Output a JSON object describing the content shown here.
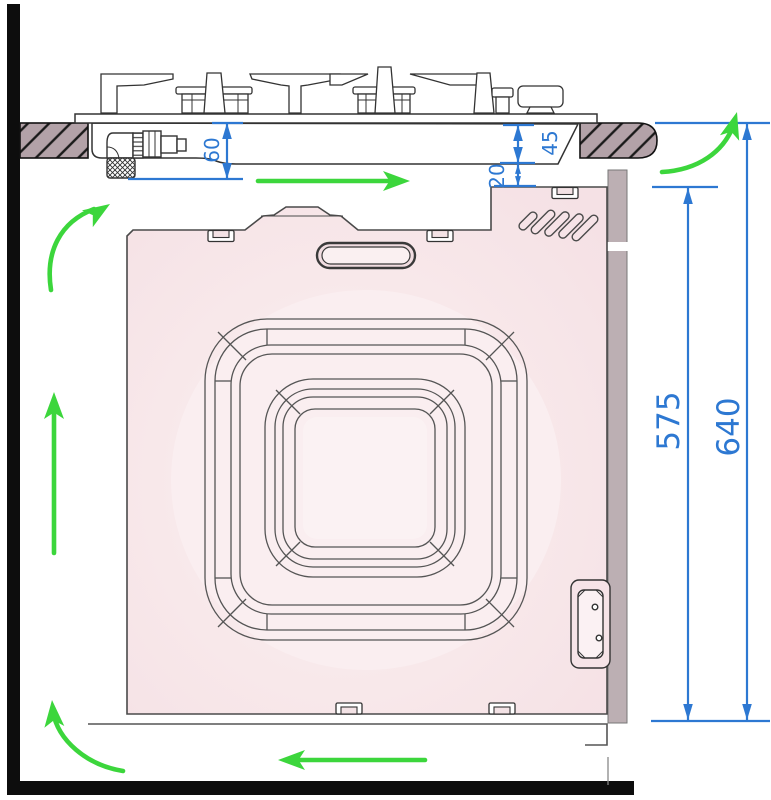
{
  "diagram": {
    "type": "built-in-oven-installation-cross-section",
    "dimensions": {
      "hob_depth": "60",
      "hob_clearance": "45",
      "oven_top_gap": "20",
      "oven_recess_height": "575",
      "niche_total_height": "640"
    },
    "colors": {
      "dimension_blue": "#2d78d2",
      "airflow_green": "#3cd63c",
      "oven_body_pink": "#f7e5e8",
      "rear_panel_grey": "#bcafb3",
      "worktop_grey": "#b3a2a8",
      "wall_black": "#0d0d0d"
    },
    "airflow_arrows": [
      {
        "name": "airflow-under-hob-arrow",
        "direction": "right"
      },
      {
        "name": "airflow-top-left-curve-arrow",
        "direction": "up-right"
      },
      {
        "name": "airflow-left-vertical-arrow",
        "direction": "up"
      },
      {
        "name": "airflow-bottom-left-curve-arrow",
        "direction": "up"
      },
      {
        "name": "airflow-under-oven-arrow",
        "direction": "left"
      },
      {
        "name": "airflow-rear-outlet-curve-arrow",
        "direction": "up"
      }
    ]
  }
}
